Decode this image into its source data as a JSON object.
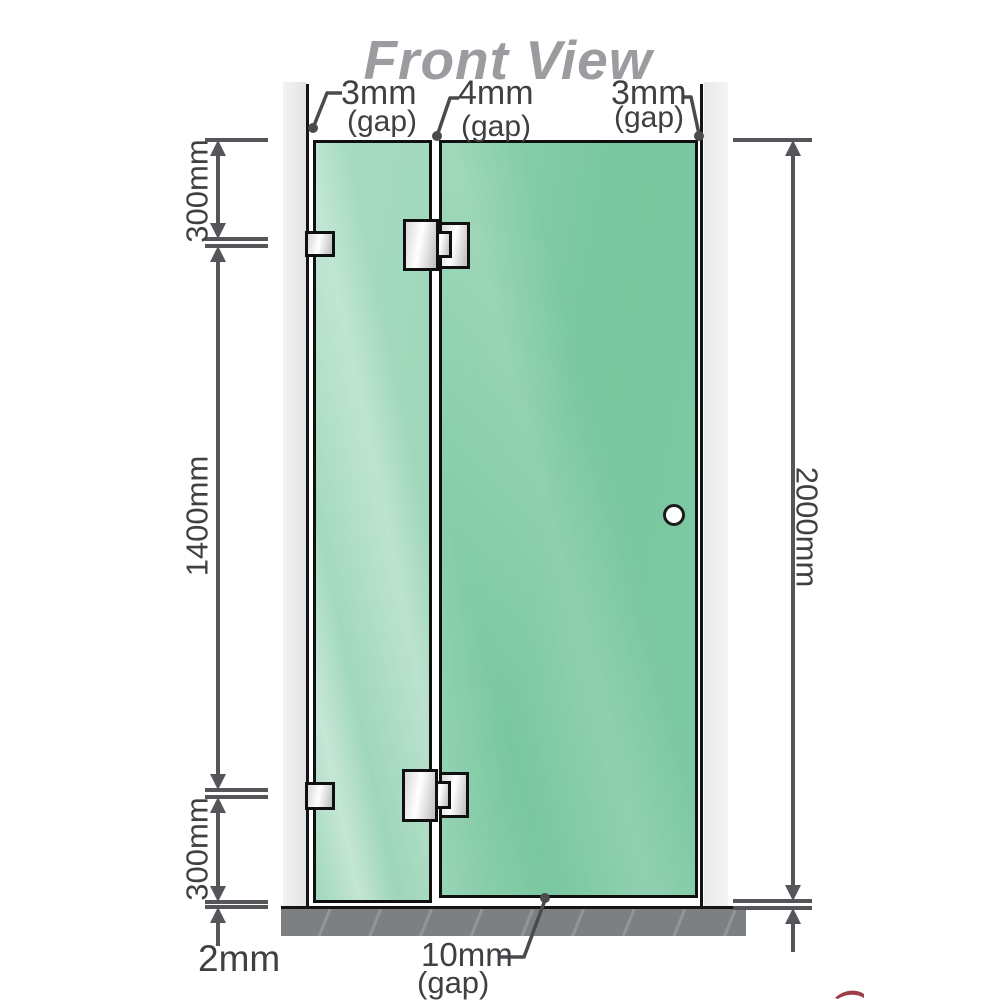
{
  "title": "Front View",
  "labels": {
    "gap_left": {
      "value": "3mm",
      "suffix": "(gap)"
    },
    "gap_middle": {
      "value": "4mm",
      "suffix": "(gap)"
    },
    "gap_right": {
      "value": "3mm",
      "suffix": "(gap)"
    },
    "height_top": "300mm",
    "height_middle": "1400mm",
    "height_bottom": "300mm",
    "height_total": "2000mm",
    "floor_gap_panel": "2mm",
    "floor_gap_door": {
      "value": "10mm",
      "suffix": "(gap)"
    }
  },
  "colors": {
    "glass_fixed_panel": "#a8dcc2",
    "glass_door": "#7cc8a2",
    "wall": "#e9e9e9",
    "floor_base": "#7d8083",
    "dimension_lines": "#55565a",
    "label_text": "#3f4043",
    "title_text": "#9a9ca0",
    "logo_accent": "#8c1d2c"
  },
  "icons": {
    "door_handle": "circle-knob-icon"
  }
}
